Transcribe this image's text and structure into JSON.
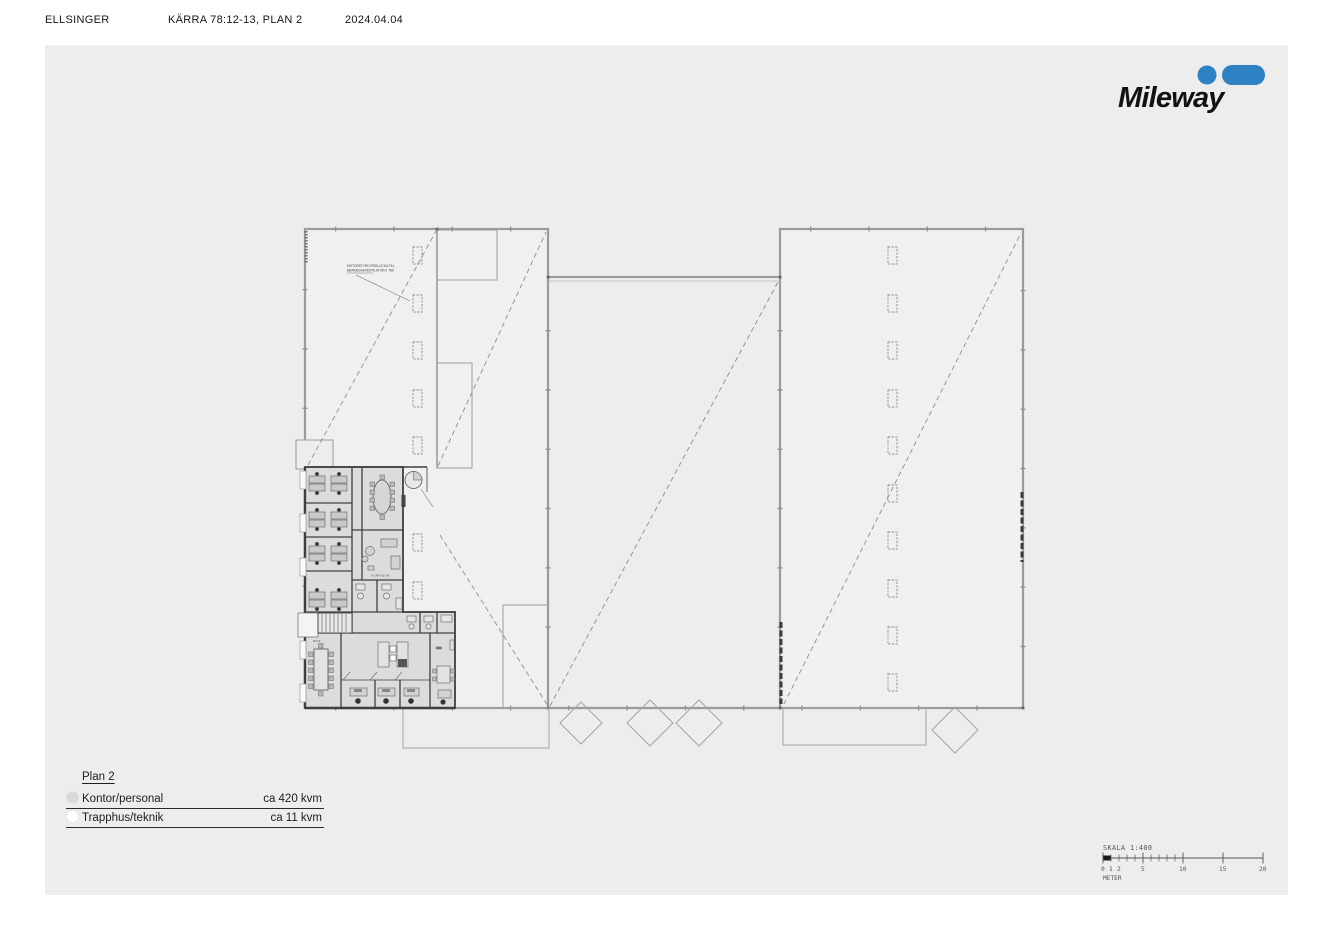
{
  "header": {
    "company": "ELLSINGER",
    "title": "KÄRRA 78:12-13,  PLAN 2",
    "date": "2024.04.04"
  },
  "logo": {
    "text": "Mileway",
    "brand_color": "#2e82c3"
  },
  "legend": {
    "plan_label": "Plan 2",
    "items": [
      {
        "label": "Kontor/personal",
        "value": "ca 420 kvm",
        "swatch": "#d9d9d9"
      },
      {
        "label": "Trapphus/teknik",
        "value": "ca 11 kvm",
        "swatch": "#ffffff"
      }
    ]
  },
  "scalebar": {
    "title": "SKALA 1:400",
    "unit": "METER",
    "tick_labels": [
      "0",
      "1",
      "2",
      "5",
      "10",
      "15",
      "20"
    ]
  },
  "plan": {
    "annotation_line1": "MOTORSTYRD RÖKLUCKA TILL",
    "annotation_line2": "BRANDGASVENTILATION I TAK",
    "rooms": {
      "corridor": "KORRIDOR",
      "meeting": "MÖTE",
      "storage": "FRD"
    }
  }
}
